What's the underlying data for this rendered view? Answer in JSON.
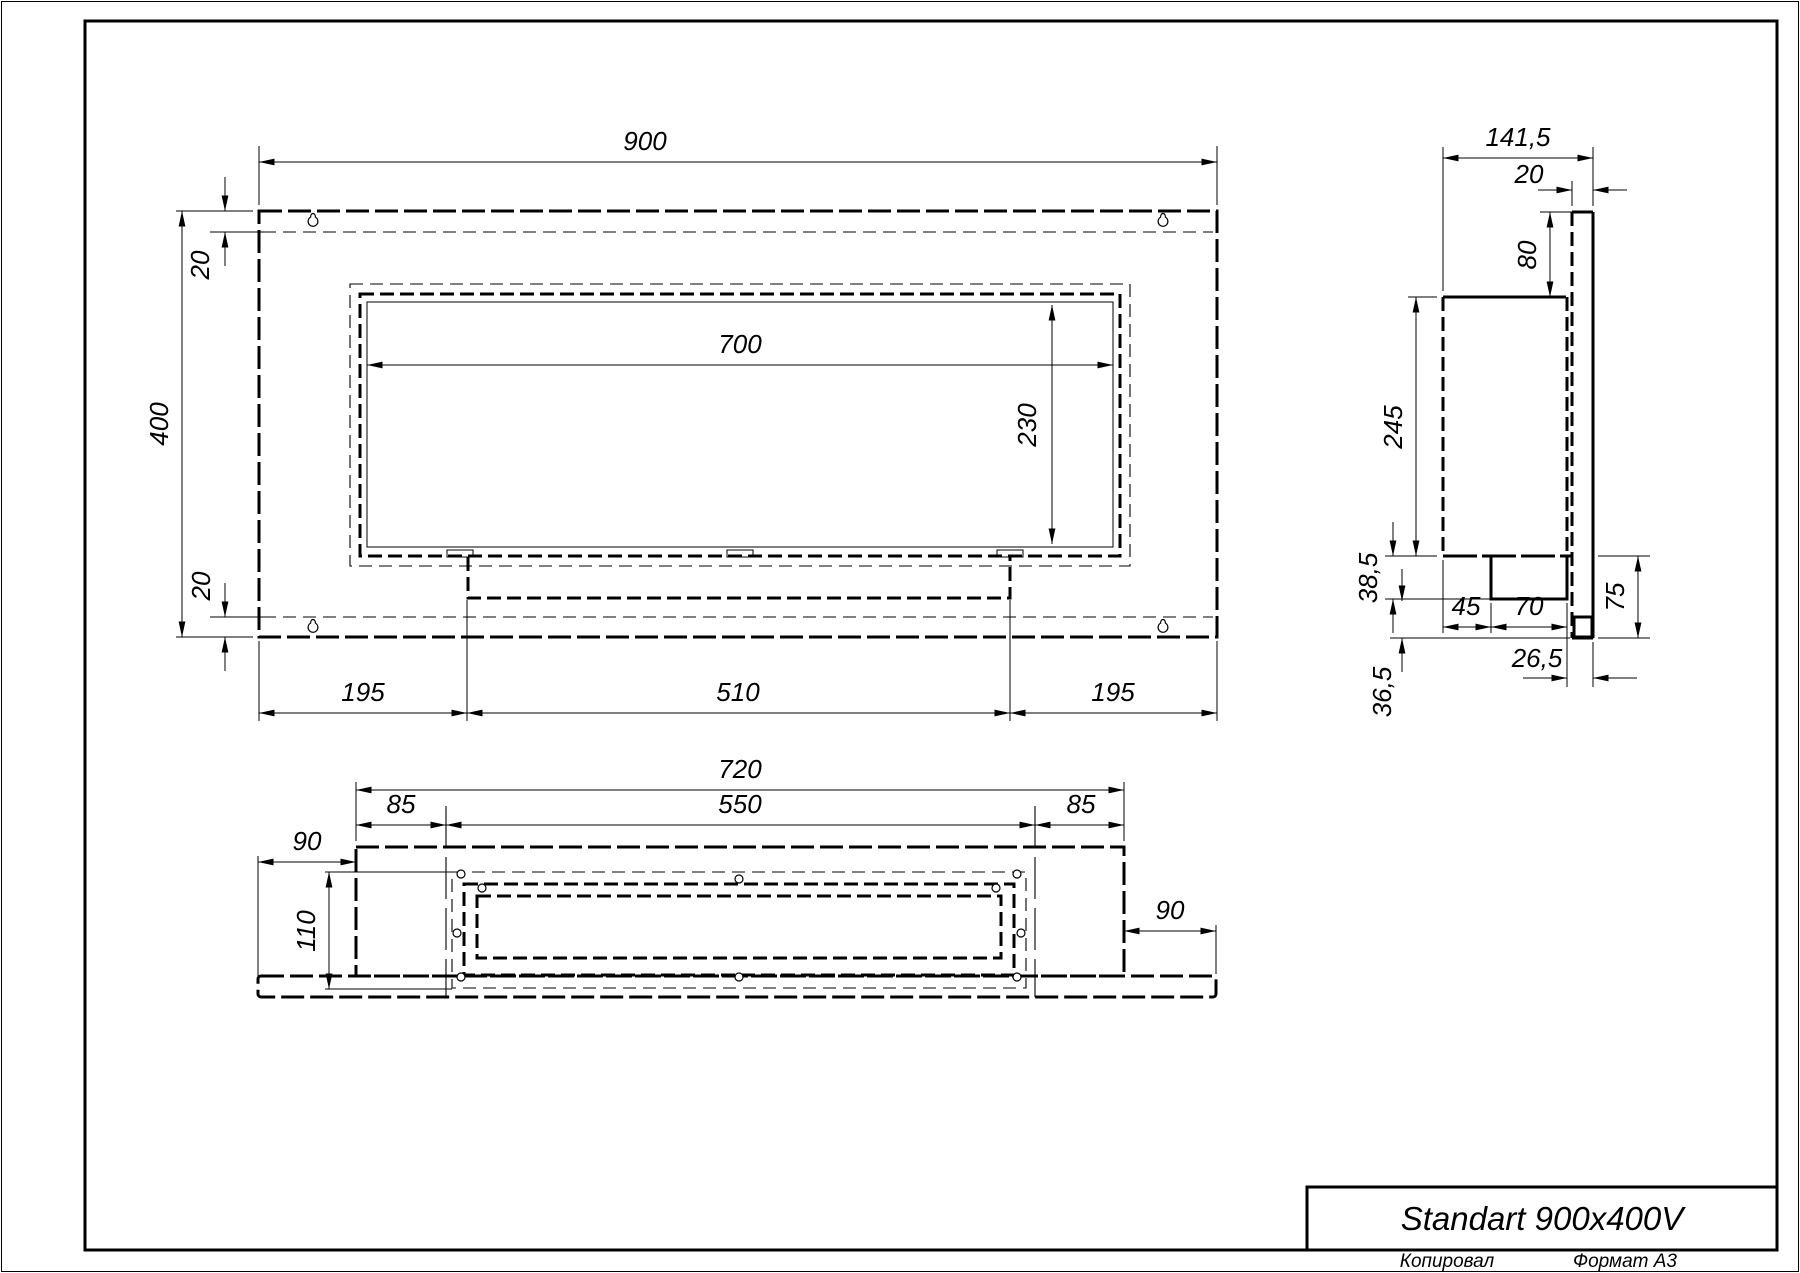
{
  "sheet": {
    "title": "Standart 900x400V",
    "copied_label": "Копировал",
    "format_label": "Формат А3"
  },
  "front_view": {
    "dims": {
      "overall_width": "900",
      "overall_height": "400",
      "top_offset": "20",
      "bottom_offset": "20",
      "opening_width": "700",
      "opening_height": "230",
      "bottom_left": "195",
      "bottom_center": "510",
      "bottom_right": "195"
    }
  },
  "side_view": {
    "dims": {
      "overall_depth": "141,5",
      "panel_thickness": "20",
      "panel_above_top": "80",
      "body_height": "245",
      "burner_drop": "38,5",
      "burner_front_gap": "45",
      "burner_width": "70",
      "lower_right_height": "75",
      "burner_to_panel": "26,5",
      "lower_left_height": "36,5"
    }
  },
  "bottom_view": {
    "dims": {
      "body_width": "720",
      "left_inset": "85",
      "opening_width": "550",
      "right_inset": "85",
      "plate_left_ext": "90",
      "plate_right_ext": "90",
      "depth": "110"
    }
  }
}
